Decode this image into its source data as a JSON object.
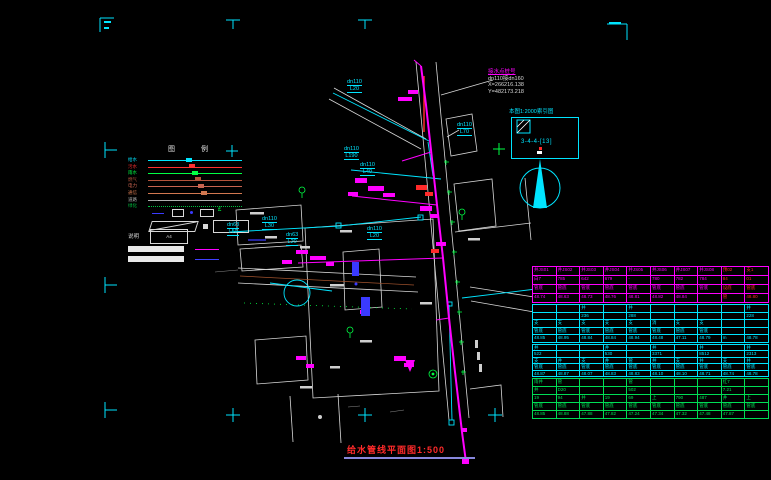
{
  "title_block": {
    "text": "给水管线平面图1:500"
  },
  "tie_in": {
    "title": "接水点桩号",
    "spec": "dn110接dn160",
    "x_coord": "X=266216.138",
    "y_coord": "Y=482173.218"
  },
  "index_box": {
    "title": "本图1:2000索引图",
    "label": "3-4-4-[13]"
  },
  "north": {
    "label": "北"
  },
  "legend": {
    "title": "图  例",
    "pipe_rows": [
      {
        "label": "给水",
        "color": "#00e5ff",
        "dotted": false
      },
      {
        "label": "污水",
        "color": "#ff3030",
        "dotted": false
      },
      {
        "label": "雨水",
        "color": "#00ff44",
        "dotted": false
      },
      {
        "label": "燃气",
        "color": "#b4543c",
        "dotted": false
      },
      {
        "label": "电力",
        "color": "#c86450",
        "dotted": false
      },
      {
        "label": "通信",
        "color": "#d27850",
        "dotted": false
      },
      {
        "label": "道路",
        "color": "#b0b0b0",
        "dotted": false
      },
      {
        "label": "绿化",
        "color": "#00c040",
        "dotted": true
      }
    ],
    "note_label": "说明",
    "note_box": "A4"
  },
  "pipe_labels": [
    {
      "t": "dn110",
      "s": "L20",
      "x": 347,
      "y": 79
    },
    {
      "t": "dn110",
      "s": "L70",
      "x": 457,
      "y": 122
    },
    {
      "t": "dn110",
      "s": "L190",
      "x": 344,
      "y": 146
    },
    {
      "t": "dn110",
      "s": "L40",
      "x": 360,
      "y": 162
    },
    {
      "t": "dn110",
      "s": "L30",
      "x": 262,
      "y": 216
    },
    {
      "t": "dn63",
      "s": "L50",
      "x": 227,
      "y": 222
    },
    {
      "t": "dn63",
      "s": "L20",
      "x": 286,
      "y": 232
    },
    {
      "t": "dn110",
      "s": "L20",
      "x": 367,
      "y": 226
    }
  ],
  "table": {
    "x": 532,
    "y": 266,
    "w": 237,
    "groups": [
      {
        "color": "#ff00ff",
        "h": 38,
        "alt_cols": [
          8,
          9
        ],
        "rows": [
          [
            "井JS01",
            "井JS02",
            "井JS03",
            "井JS04",
            "井JS05",
            "井JS06",
            "井JS07",
            "井JS08",
            "预02",
            "支1"
          ],
          [
            "白7",
            "785",
            "642",
            "679",
            "-",
            "780",
            "782",
            "784",
            "84",
            "01"
          ],
          [
            "管底",
            "管底",
            "管底",
            "管底",
            "管底",
            "管底",
            "管底",
            "管底",
            "设底",
            "管底"
          ],
          [
            "48.74",
            "48.63",
            "48.73",
            "48.76",
            "48.81",
            "48.82",
            "48.84",
            "",
            "管",
            "48.80"
          ]
        ]
      },
      {
        "color": "#00e5ff",
        "h": 40,
        "alt_cols": [],
        "rows": [
          [
            "",
            "",
            "井",
            "",
            "井",
            "",
            "",
            "",
            "",
            "井"
          ],
          [
            "",
            "",
            "236",
            "",
            "288",
            "",
            "",
            "",
            "",
            "228"
          ],
          [
            "支",
            "支",
            "支",
            "支",
            "支",
            "消",
            "支",
            "支",
            "",
            ""
          ],
          [
            "管底",
            "管底",
            "管底",
            "管底",
            "管底",
            "管底",
            "管底",
            "管底",
            "",
            ""
          ],
          [
            "48.85",
            "48.95",
            "48.84",
            "48.84",
            "48.94",
            "48.48",
            "47.11",
            "48.79",
            "m",
            "48.78"
          ]
        ]
      },
      {
        "color": "#00e5ff",
        "h": 34,
        "alt_cols": [],
        "rows": [
          [
            "井",
            "",
            "",
            "井",
            "",
            "井",
            "",
            "井",
            "",
            "井"
          ],
          [
            "522",
            "",
            "",
            "530",
            "",
            "3371",
            "",
            "8512",
            "",
            "2313"
          ],
          [
            "支",
            "井",
            "支",
            "井",
            "管",
            "井",
            "支",
            "井",
            "支",
            "井"
          ],
          [
            "管底",
            "管底",
            "管底",
            "管底",
            "管底",
            "管底",
            "管底",
            "管底",
            "管底",
            "管底"
          ],
          [
            "48.87",
            "48.87",
            "48.07",
            "48.83",
            "48.83",
            "48.10",
            "48.10",
            "48.71",
            "48.74",
            "48.78"
          ]
        ]
      },
      {
        "color": "#00dd55",
        "h": 42,
        "alt_cols": [],
        "rows": [
          [
            "雨井",
            "管",
            "",
            "",
            "管",
            "",
            "",
            "",
            "红7",
            ""
          ],
          [
            "井",
            "D20",
            "",
            "",
            "502",
            "",
            "",
            "",
            "7.21",
            ""
          ],
          [
            "19",
            "94",
            "井",
            "19",
            "69",
            "上",
            "790",
            "487",
            "井",
            "上"
          ],
          [
            "管底",
            "管底",
            "管底",
            "管底",
            "管底",
            "管底",
            "管底",
            "管底",
            "管底",
            "管底"
          ],
          [
            "48.85",
            "48.88",
            "47.88",
            "47.82",
            "47.24",
            "47.34",
            "47.32",
            "47.48",
            "47.87",
            ""
          ]
        ]
      }
    ]
  }
}
